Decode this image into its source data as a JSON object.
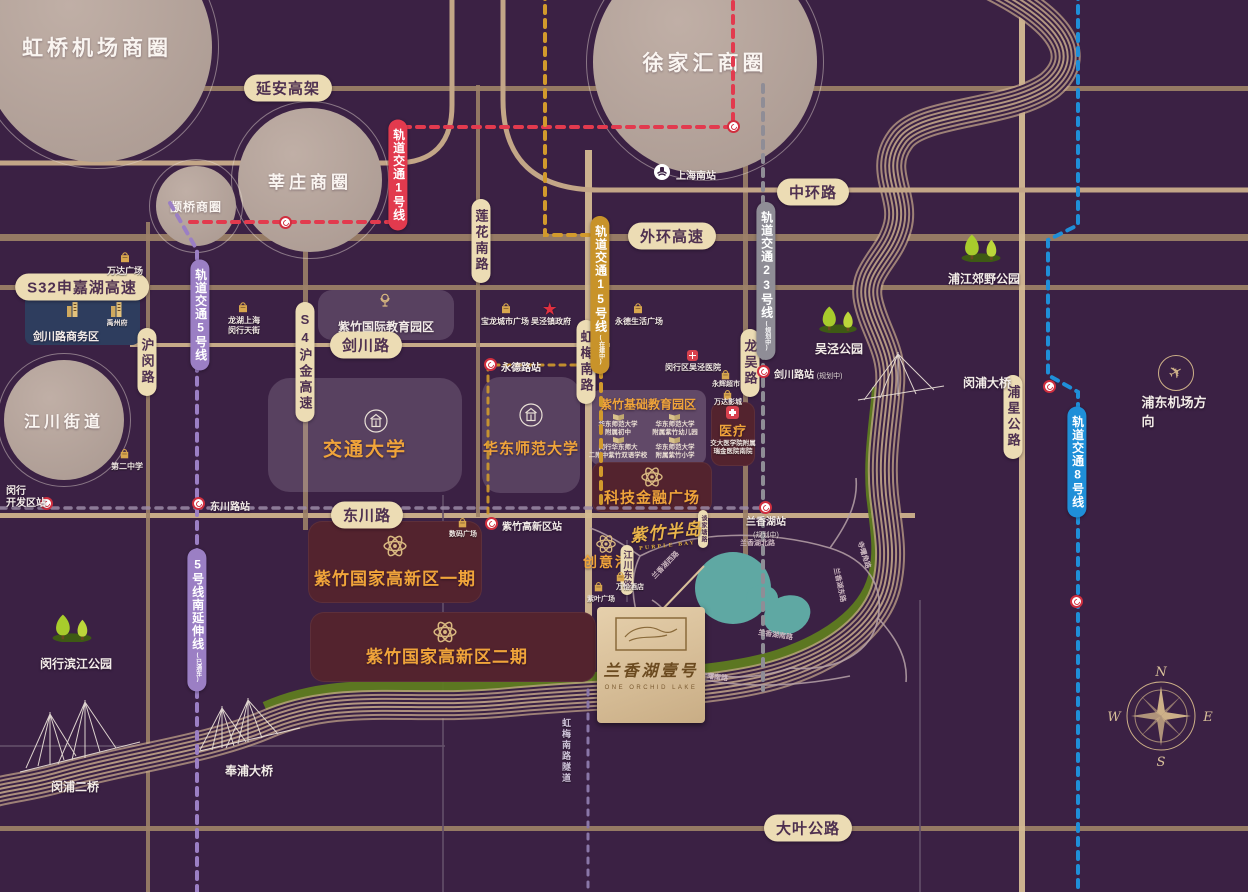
{
  "circles": {
    "hongqiao": "虹桥机场商圈",
    "xujiahui": "徐家汇商圈",
    "xinzhuang": "莘庄商圈",
    "zhuanqiao": "颛桥商圈",
    "jiangchuan": "江川街道"
  },
  "roads": {
    "yanan": "延安高架",
    "zhonghuan": "中环路",
    "waihuan": "外环高速",
    "s32": "S32申嘉湖高速",
    "jianchuan": "剑川路",
    "dongchuan": "东川路",
    "daye": "大叶公路",
    "humin": "沪闵路",
    "s4": "S4沪金高速",
    "lianhua": "莲花南路",
    "hongmei": "虹梅南路",
    "longwu": "龙吴路",
    "puxing": "浦星公路",
    "jiangchuan_e": "江川东路",
    "hongmei_tunnel": "虹梅南路隧道",
    "lx_north": "兰香湖北路",
    "lx_east": "兰香湖东路",
    "lx_south": "兰香湖南路",
    "lx_west": "兰香湖西路",
    "yuelan": "悦兰路",
    "sishu_e": "寺曙角路",
    "sishu_s": "寺曙南路",
    "tanjiatang": "谈家塘路"
  },
  "metro": {
    "line1": "轨道交通1号线",
    "line5": "轨道交通5号线",
    "line15": "轨道交通15号线",
    "line15_note": "(在建中)",
    "line23": "轨道交通23号线",
    "line23_note": "(规划中)",
    "line8": "轨道交通8号线",
    "line5s": "5号线南延伸线",
    "line5s_note": "(已通车)"
  },
  "stations": {
    "shanghai_south": "上海南站",
    "yongde": "永德路站",
    "dongchuan": "东川路站",
    "minhang_kfq": "闵行\n开发区站",
    "jianchuan": "剑川路站",
    "jianchuan_note": "(规划中)",
    "zizhu": "紫竹高新区站",
    "lanxianghu": "兰香湖站",
    "lanxianghu_note": "(规划中)"
  },
  "pois": {
    "wanda": "万达广场",
    "longhu": "龙湖上海\n闵行天街",
    "baolong": "宝龙城市广场",
    "wujing_gov": "吴泾镇政府",
    "yongde_plaza": "永德生活广场",
    "wujing_hospital": "闵行区吴泾医院",
    "yonghui": "永辉超市",
    "wanda_cinema": "万达影城",
    "no2_school": "第二中学",
    "yuzhoufu": "禹州府",
    "jianchuan_biz": "剑川路商务区",
    "shuma": "数码广场",
    "wanyi": "万怡酒店",
    "ziye": "紫叶广场"
  },
  "districts": {
    "edu_intl": "紫竹国际教育园区",
    "jiaotong": "交通大学",
    "huashida": "华东师范大学",
    "edu_basic": "紫竹基础教育园区",
    "schools": [
      "华东师范大学\n附属初中",
      "华东师范大学\n附属紫竹幼儿园",
      "闵行华东师大\n二附中紫竹双语学校",
      "华东师范大学\n附属紫竹小学"
    ],
    "medical": "医疗",
    "hospital": "交大医学院附属\n瑞金医院南院",
    "fintech": "科技金融广场",
    "hitech1": "紫竹国家高新区一期",
    "hitech2": "紫竹国家高新区二期",
    "cyg": "创意港"
  },
  "parks": {
    "pujiang": "浦江郊野公园",
    "wujing": "吴泾公园",
    "minhang_bj": "闵行滨江公园",
    "zizhu_bj": "紫竹滨江公园"
  },
  "bridges": {
    "minpu": "闵浦大桥",
    "minpu2": "闵浦二桥",
    "fengpu": "奉浦大桥"
  },
  "landmarks": {
    "airport": "浦东机场方向",
    "brand": "紫竹半岛",
    "brand_en": "PURPLE BAY",
    "project": "兰香湖壹号",
    "project_en": "ONE ORCHID LAKE"
  },
  "compass": {
    "n": "N",
    "e": "E",
    "s": "S",
    "w": "W"
  },
  "colors": {
    "bg": "#3B2144",
    "road": "#C2A280",
    "capsule": "#ECDCB4",
    "line1": "#E23A4E",
    "line5": "#9B7FC4",
    "line15": "#D29A2C",
    "line23": "#8F8D96",
    "line8": "#1F8FD8",
    "gold": "#F0A43A",
    "lake": "#5FA8A3",
    "green": "#5E7C20",
    "box_red": "#53232E",
    "box_navy": "#2E3D5E"
  }
}
